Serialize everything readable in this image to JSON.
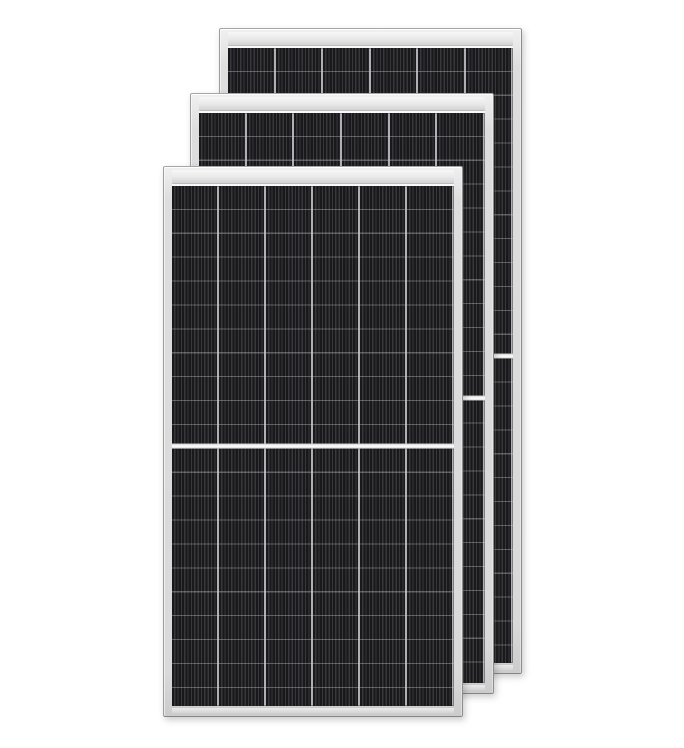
{
  "scene": {
    "description": "Product render of three overlapping black monocrystalline half-cut solar panels with silver aluminum frames on a white background",
    "background_color": "#ffffff",
    "canvas": {
      "width": 684,
      "height": 748
    }
  },
  "style": {
    "cell_color": "#19191b",
    "cell_stripe_color": "#38383c",
    "grid_line_color": "#b0b0b4",
    "frame_color": "#d9d9d9",
    "frame_edge_color": "#8d8d8d",
    "divider_color": "#fbfbfb"
  },
  "panels": [
    {
      "name": "solar-panel-back",
      "x": 219,
      "y": 28,
      "width": 303,
      "height": 646,
      "z": 1,
      "columns": 6,
      "half_divider_position": "50%"
    },
    {
      "name": "solar-panel-middle",
      "x": 190,
      "y": 93,
      "width": 304,
      "height": 601,
      "z": 2,
      "columns": 6,
      "half_divider_position": "50%"
    },
    {
      "name": "solar-panel-front",
      "x": 163,
      "y": 166,
      "width": 300,
      "height": 551,
      "z": 3,
      "columns": 6,
      "half_divider_position": "50%"
    }
  ]
}
